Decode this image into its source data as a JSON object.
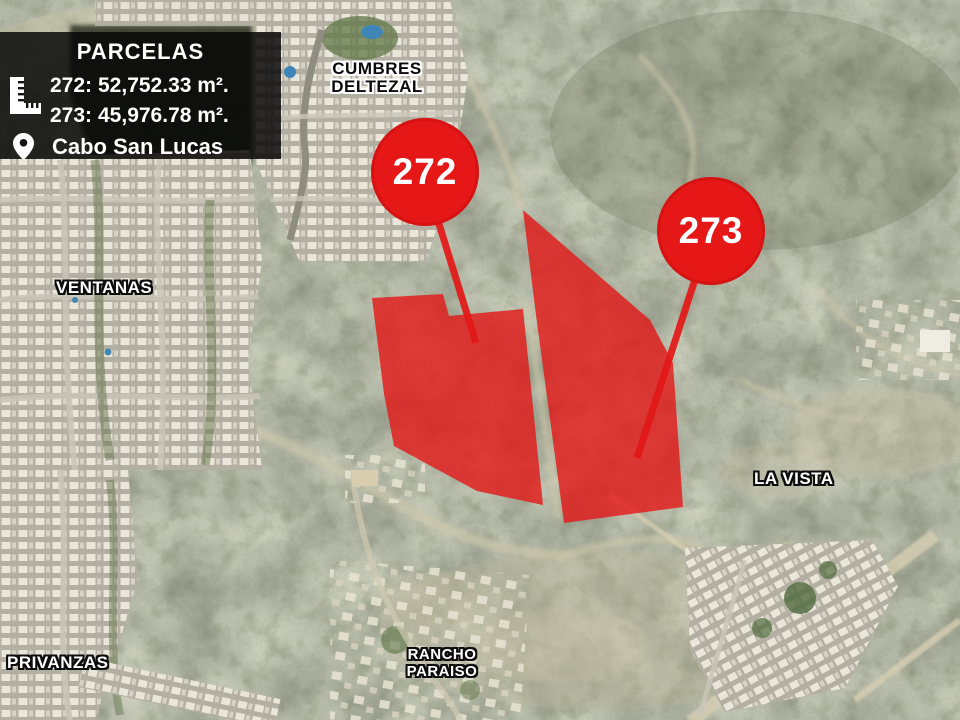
{
  "header_box": {
    "title": "PARCELAS",
    "rows": [
      {
        "id": "272:",
        "area": "52,752.33 m²."
      },
      {
        "id": "273:",
        "area": "45,976.78 m²."
      }
    ],
    "location": "Cabo San Lucas"
  },
  "map": {
    "labels": {
      "cumbres_line1": "CUMBRES",
      "cumbres_line2": "DELTEZAL",
      "ventanas": "VENTANAS",
      "la_vista": "LA VISTA",
      "privanzas": "PRIVANZAS",
      "rancho_line1": "RANCHO",
      "rancho_line2": "PARAISO"
    },
    "badges": [
      {
        "label": "272"
      },
      {
        "label": "273"
      }
    ],
    "parcel_272": {
      "points": "372,298 443,294 449,316 523,309 543,505 477,491 394,446 384,394"
    },
    "parcel_273": {
      "points": "523,210 650,320 673,363 683,507 564,523 536,315"
    },
    "colors": {
      "parcel_fill": "#e31717",
      "badge_red": "#e51717"
    }
  }
}
